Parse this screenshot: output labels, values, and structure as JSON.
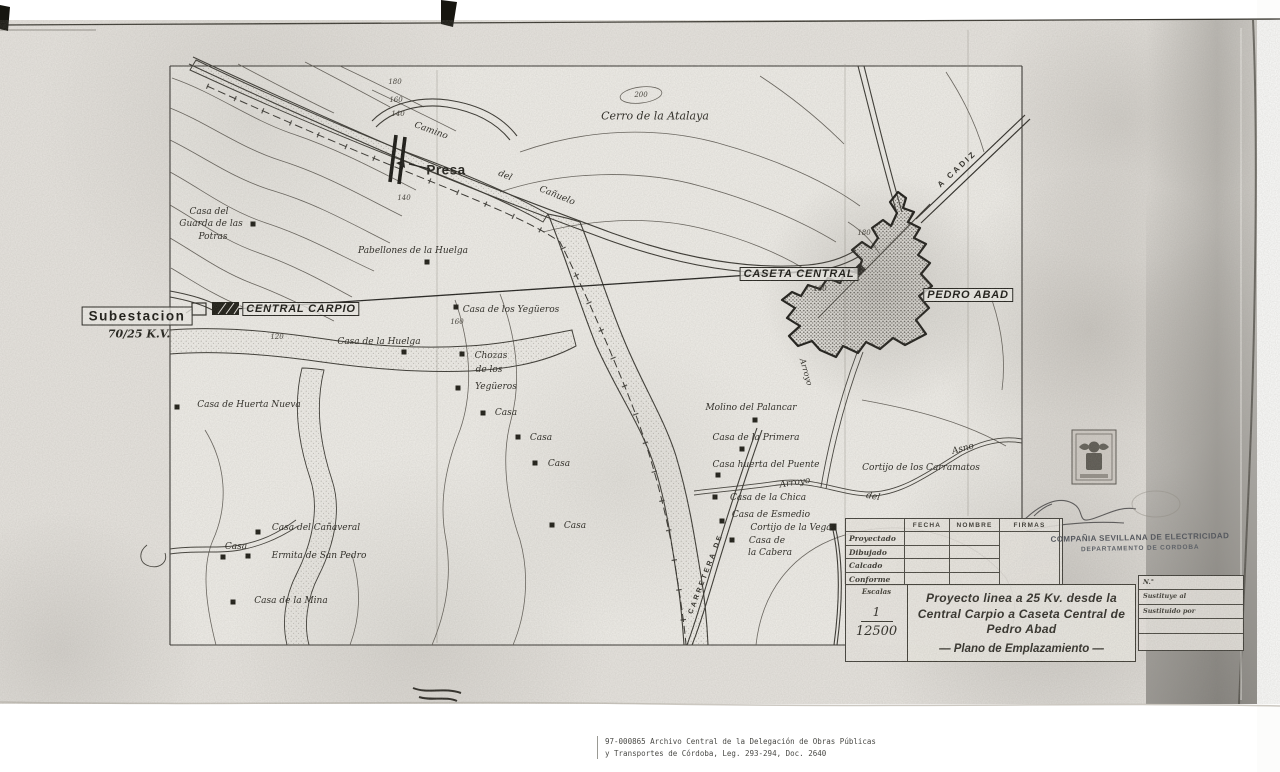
{
  "map": {
    "boxed": [
      {
        "t": "Subestacion",
        "x": 137,
        "y": 316,
        "cls": "big"
      },
      {
        "t": "CENTRAL CARPIO",
        "x": 301,
        "y": 309
      },
      {
        "t": "CASETA CENTRAL",
        "x": 799,
        "y": 274
      },
      {
        "t": "PEDRO ABAD",
        "x": 968,
        "y": 295
      }
    ],
    "labels": [
      {
        "t": "Casa del",
        "x": 209,
        "y": 212
      },
      {
        "t": "Guarda de las",
        "x": 211,
        "y": 224
      },
      {
        "t": "Potras",
        "x": 213,
        "y": 237
      },
      {
        "t": "Pabellones de la Huelga",
        "x": 413,
        "y": 251
      },
      {
        "t": "Cerro de la Atalaya",
        "x": 655,
        "y": 116,
        "c": "script big"
      },
      {
        "t": "Presa",
        "x": 446,
        "y": 170,
        "c": "presa"
      },
      {
        "t": "70/25 K.V.",
        "x": 139,
        "y": 334,
        "c": "kv"
      },
      {
        "t": "Casa de los Yegüeros",
        "x": 511,
        "y": 310
      },
      {
        "t": "Casa de la Huelga",
        "x": 379,
        "y": 342
      },
      {
        "t": "Chozas",
        "x": 491,
        "y": 356
      },
      {
        "t": "de los",
        "x": 489,
        "y": 370
      },
      {
        "t": "Yegüeros",
        "x": 496,
        "y": 387
      },
      {
        "t": "Casa",
        "x": 506,
        "y": 413
      },
      {
        "t": "Casa",
        "x": 541,
        "y": 438
      },
      {
        "t": "Casa",
        "x": 559,
        "y": 464
      },
      {
        "t": "Casa",
        "x": 575,
        "y": 526
      },
      {
        "t": "Casa de Huerta Nueva",
        "x": 249,
        "y": 405
      },
      {
        "t": "Molino del Palancar",
        "x": 751,
        "y": 408
      },
      {
        "t": "Casa de la Primera",
        "x": 756,
        "y": 438
      },
      {
        "t": "Casa huerta del Puente",
        "x": 766,
        "y": 465
      },
      {
        "t": "Cortijo de los Carramatos",
        "x": 921,
        "y": 468
      },
      {
        "t": "Casa de la Chica",
        "x": 768,
        "y": 498
      },
      {
        "t": "Casa de Esmedio",
        "x": 771,
        "y": 515
      },
      {
        "t": "Cortijo de la Vega",
        "x": 791,
        "y": 528
      },
      {
        "t": "Casa de",
        "x": 767,
        "y": 541
      },
      {
        "t": "la Cabera",
        "x": 770,
        "y": 553
      },
      {
        "t": "Casa del Cañaveral",
        "x": 316,
        "y": 528
      },
      {
        "t": "Casa",
        "x": 236,
        "y": 547
      },
      {
        "t": "Ermita de San Pedro",
        "x": 319,
        "y": 556
      },
      {
        "t": "Casa de la Mina",
        "x": 291,
        "y": 601
      },
      {
        "t": "Camino",
        "x": 431,
        "y": 131,
        "r": 20
      },
      {
        "t": "del",
        "x": 505,
        "y": 176,
        "r": 22
      },
      {
        "t": "Cañuelo",
        "x": 557,
        "y": 196,
        "r": 22
      },
      {
        "t": "A CADIZ",
        "x": 957,
        "y": 169,
        "r": -43,
        "c": "caps"
      },
      {
        "t": "Arroyo",
        "x": 795,
        "y": 483,
        "r": -9
      },
      {
        "t": "del",
        "x": 873,
        "y": 497,
        "r": 10
      },
      {
        "t": "Asno",
        "x": 963,
        "y": 449,
        "r": -15
      },
      {
        "t": "Arroyo",
        "x": 806,
        "y": 372,
        "r": 74,
        "s": 8
      },
      {
        "t": "CARRETERA DE",
        "x": 706,
        "y": 574,
        "r": -69,
        "c": "caps",
        "s": 7
      },
      {
        "t": "180",
        "x": 395,
        "y": 82,
        "c": "num"
      },
      {
        "t": "160",
        "x": 396,
        "y": 100,
        "c": "num"
      },
      {
        "t": "140",
        "x": 398,
        "y": 114,
        "c": "num"
      },
      {
        "t": "140",
        "x": 404,
        "y": 198,
        "c": "num"
      },
      {
        "t": "200",
        "x": 641,
        "y": 95,
        "c": "num"
      },
      {
        "t": "180",
        "x": 864,
        "y": 233,
        "c": "num"
      },
      {
        "t": "180",
        "x": 820,
        "y": 289,
        "c": "num"
      },
      {
        "t": "120",
        "x": 277,
        "y": 337,
        "c": "num"
      },
      {
        "t": "160",
        "x": 457,
        "y": 322,
        "c": "num"
      }
    ],
    "markers": [
      {
        "x": 253,
        "y": 224
      },
      {
        "x": 427,
        "y": 262
      },
      {
        "x": 456,
        "y": 307
      },
      {
        "x": 462,
        "y": 354
      },
      {
        "x": 458,
        "y": 388
      },
      {
        "x": 483,
        "y": 413
      },
      {
        "x": 518,
        "y": 437
      },
      {
        "x": 535,
        "y": 463
      },
      {
        "x": 552,
        "y": 525
      },
      {
        "x": 177,
        "y": 407
      },
      {
        "x": 404,
        "y": 352
      },
      {
        "x": 755,
        "y": 420
      },
      {
        "x": 742,
        "y": 449
      },
      {
        "x": 718,
        "y": 475
      },
      {
        "x": 715,
        "y": 497
      },
      {
        "x": 722,
        "y": 521
      },
      {
        "x": 732,
        "y": 540
      },
      {
        "x": 833,
        "y": 527,
        "s": 7
      },
      {
        "x": 258,
        "y": 532
      },
      {
        "x": 223,
        "y": 557
      },
      {
        "x": 248,
        "y": 556
      },
      {
        "x": 233,
        "y": 602
      }
    ]
  },
  "title_block": {
    "table": {
      "headers": [
        "FECHA",
        "NOMBRE",
        "FIRMAS"
      ],
      "rows": [
        "Proyectado",
        "Dibujado",
        "Calcado",
        "Conforme"
      ]
    },
    "escala_label": "Escalas",
    "scale_num": "1",
    "scale_den": "12500",
    "title_lines": [
      "Proyecto linea a 25 Kv. desde la",
      "Central Carpio a Caseta Central de",
      "Pedro Abad"
    ],
    "subtitle": "— Plano de Emplazamiento —",
    "company_line1": "COMPAÑIA SEVILLANA DE ELECTRICIDAD",
    "company_line2": "DEPARTAMENTO DE CORDOBA",
    "info_rows": [
      "N.°",
      "Sustituye al",
      "Sustituido por",
      "",
      ""
    ]
  },
  "footer": {
    "ref_line1": "97-000865  Archivo Central de la Delegación de Obras Públicas",
    "ref_line2": "y Transportes de Córdoba, Leg. 293-294, Doc. 2640"
  }
}
